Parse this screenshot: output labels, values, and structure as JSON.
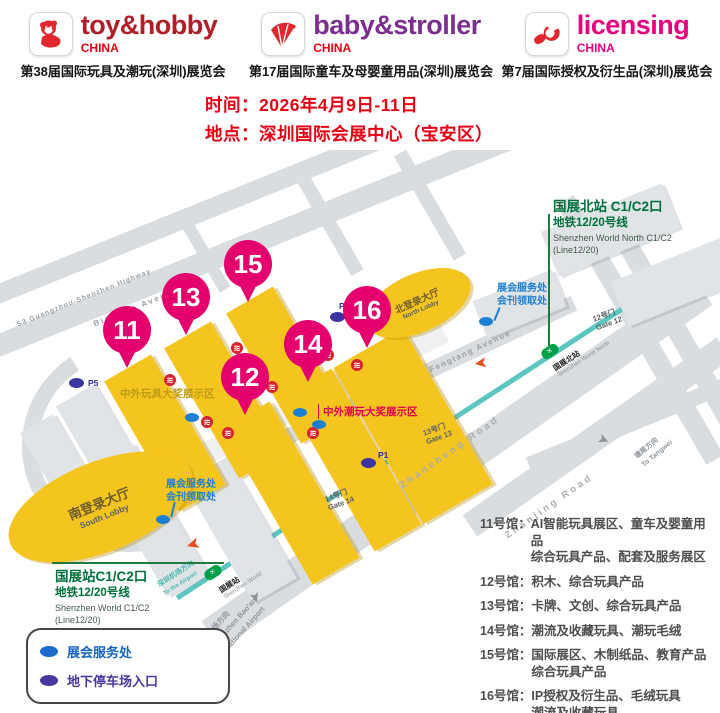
{
  "header": {
    "brands": [
      {
        "name": "toy&hobby",
        "country": "CHINA",
        "subtitle": "第38届国际玩具及潮玩(深圳)展览会"
      },
      {
        "name": "baby&stroller",
        "country": "CHINA",
        "subtitle": "第17届国际童车及母婴童用品(深圳)展览会"
      },
      {
        "name": "licensing",
        "country": "CHINA",
        "subtitle": "第7届国际授权及衍生品(深圳)展览会"
      }
    ],
    "info": {
      "time": "时间：2026年4月9日-11日",
      "place": "地点：深圳国际会展中心（宝安区）"
    }
  },
  "map": {
    "icons": {
      "metro_entrance": "≋",
      "station_logo": "✕",
      "arrow": "➤"
    },
    "north_station": {
      "title": "国展北站 C1/C2口",
      "line": "地铁12/20号线",
      "en1": "Shenzhen World North C1/C2",
      "en2": "(Line12/20)",
      "platform_zh": "国展北站",
      "platform_en": "Shenzhen World North"
    },
    "south_station": {
      "title": "国展站C1/C2口",
      "line": "地铁12/20号线",
      "en1": "Shenzhen World  C1/C2",
      "en2": "(Line12/20)",
      "platform_zh": "国展站",
      "platform_en": "Shenzhen World"
    },
    "service_note": {
      "line1": "展会服务处",
      "line2": "会刊领取处"
    },
    "lobbies": {
      "north_zh": "北登录大厅",
      "north_en": "North Lobby",
      "south_zh": "南登录大厅",
      "south_en": "South Lobby"
    },
    "pins": [
      "11",
      "13",
      "15",
      "12",
      "14",
      "16"
    ],
    "zones": {
      "toy_award": "中外玩具大奖展示区",
      "trend_award": "中外潮玩大奖展示区"
    },
    "gates": [
      {
        "zh": "12号门",
        "en": "Gate 12"
      },
      {
        "zh": "13号门",
        "en": "Gate 13"
      },
      {
        "zh": "14号门",
        "en": "Gate 14"
      }
    ],
    "roads": {
      "s3": "S3 Guangzhou-Shenzhen Highway",
      "binjiang": "Binjiang Avenue",
      "fengtang": "Fengtang Avenue",
      "zhancheng": "Zhancheng Road",
      "zhanjing": "Zhanjing Road"
    },
    "directions": {
      "airport_metro_zh": "深圳机场方向",
      "airport_metro_en": "To the Airport",
      "airport_zh": "深圳机场方向",
      "airport_en1": "To Shenzhen Bao'an",
      "airport_en2": "International Airport",
      "tangwei_zh": "塘尾方向",
      "tangwei_en": "To Tangwei"
    },
    "parking": {
      "p5": "P5",
      "p6": "P6",
      "p1": "P1"
    },
    "colors": {
      "hall_yellow": "#f5c51f",
      "pin_pink": "#e4006d",
      "metro_teal": "#5ec6c0",
      "station_green": "#00703c",
      "service_blue": "#1b7fd4",
      "parking_indigo": "#3c34a0",
      "road_gray": "#d9dde0",
      "arrow_orange": "#e84e1c"
    }
  },
  "legend": {
    "items": [
      {
        "label": "展会服务处",
        "color": "#1b6ac9"
      },
      {
        "label": "地下停车场入口",
        "color": "#46389e"
      }
    ]
  },
  "hall_list": [
    {
      "label": "11号馆：",
      "desc": "AI智能玩具展区、童车及婴童用品\n综合玩具产品、配套及服务展区"
    },
    {
      "label": "12号馆：",
      "desc": "积木、综合玩具产品"
    },
    {
      "label": "13号馆：",
      "desc": "卡牌、文创、综合玩具产品"
    },
    {
      "label": "14号馆：",
      "desc": "潮流及收藏玩具、潮玩毛绒"
    },
    {
      "label": "15号馆：",
      "desc": "国际展区、木制纸品、教育产品\n综合玩具产品"
    },
    {
      "label": "16号馆：",
      "desc": "IP授权及衍生品、毛绒玩具\n潮流及收藏玩具"
    }
  ]
}
